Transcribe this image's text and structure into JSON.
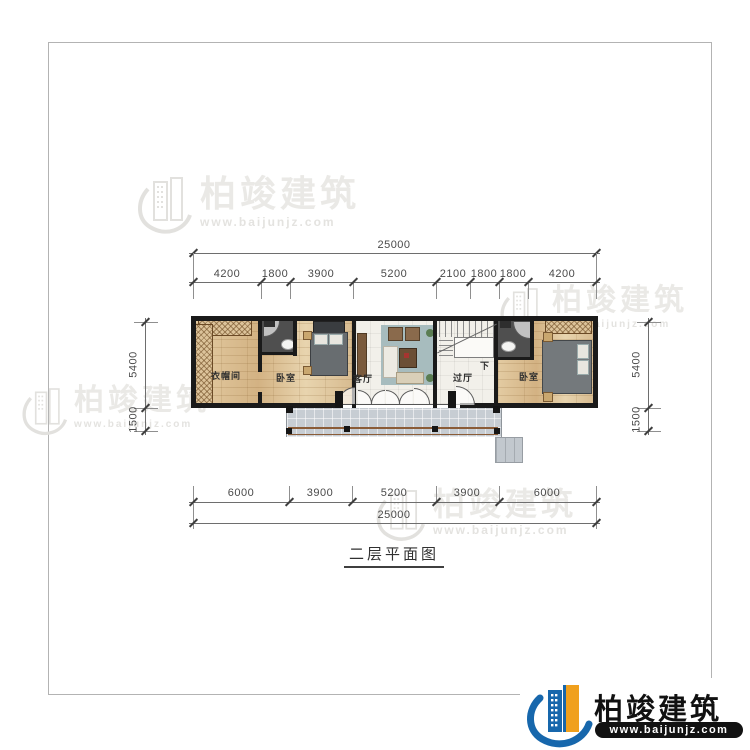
{
  "sheet": {
    "title": "二层平面图"
  },
  "brand": {
    "name": "柏竣建筑",
    "url": "www.baijunjz.com"
  },
  "watermark": {
    "name": "柏竣建筑",
    "url": "www.baijunjz.com"
  },
  "dims": {
    "top_total": "25000",
    "top_segments": [
      "4200",
      "1800",
      "3900",
      "5200",
      "2100",
      "1800",
      "1800",
      "4200"
    ],
    "bottom_segments": [
      "6000",
      "3900",
      "5200",
      "3900",
      "6000"
    ],
    "bottom_total": "25000",
    "left_upper": "5400",
    "left_lower": "1500",
    "right_upper": "5400",
    "right_lower": "1500"
  },
  "rooms": {
    "cloakroom": "衣帽间",
    "bedroom_left": "卧室",
    "living": "客厅",
    "hall": "过厅",
    "bedroom_right": "卧室",
    "stair_down": "下"
  }
}
